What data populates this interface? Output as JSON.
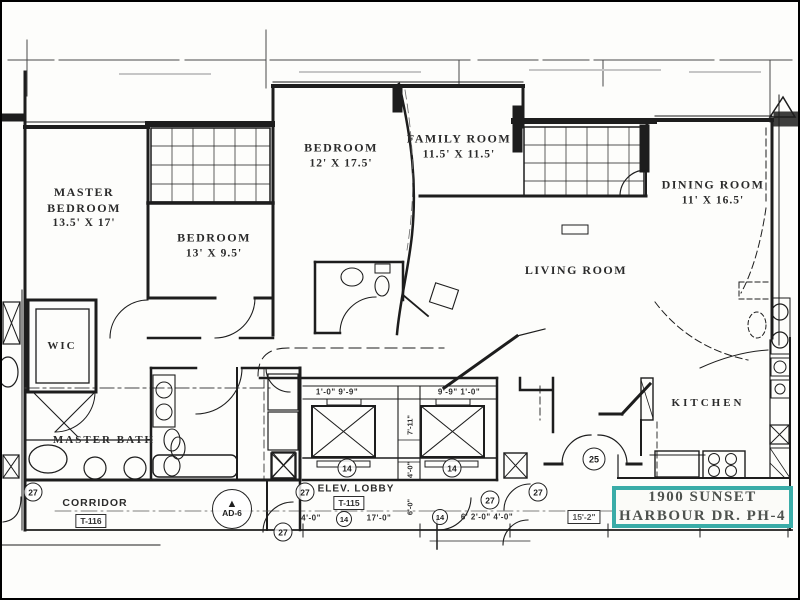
{
  "plan": {
    "rooms": {
      "master_bedroom": {
        "name": "MASTER BEDROOM",
        "dims": "13.5' X 17'"
      },
      "bedroom_small": {
        "name": "BEDROOM",
        "dims": "13' X 9.5'"
      },
      "bedroom_large": {
        "name": "BEDROOM",
        "dims": "12' X 17.5'"
      },
      "family_room": {
        "name": "FAMILY ROOM",
        "dims": "11.5' X 11.5'"
      },
      "dining_room": {
        "name": "DINING ROOM",
        "dims": "11' X 16.5'"
      },
      "living_room": {
        "name": "LIVING ROOM"
      },
      "kitchen": {
        "name": "KITCHEN"
      },
      "wic": {
        "name": "WIC"
      },
      "master_bath": {
        "name": "MASTER BATH"
      },
      "corridor": {
        "name": "CORRIDOR"
      },
      "elev_lobby": {
        "name": "ELEV. LOBBY"
      }
    },
    "tags": {
      "corridor_unit": "T-116",
      "lobby_unit": "T-115"
    },
    "markers": {
      "door_27": "27",
      "elev_14": "14",
      "entry_25": "25",
      "ad6": "AD-6",
      "ad6_symbol": "▲"
    },
    "dimensions": {
      "elev_left": "1'-0\"  9'-9\"",
      "elev_right": "9'-9\"  1'-0\"",
      "shaft_depth": "7'-11\"",
      "shaft_v2": "4'-0\"",
      "shaft_v3": "6'-0\"",
      "row_a": "4'-0\"",
      "row_b": "17'-0\"",
      "row_c": "6' 2'-0\"  4'-0\"",
      "row_d": "15'-2\""
    },
    "title_box": {
      "line1": "1900 SUNSET",
      "line2": "HARBOUR DR. PH-4",
      "border_color": "#3aaca8"
    },
    "colors": {
      "ink": "#1a1a1a",
      "highlight_teal": "#3aaca8"
    }
  }
}
